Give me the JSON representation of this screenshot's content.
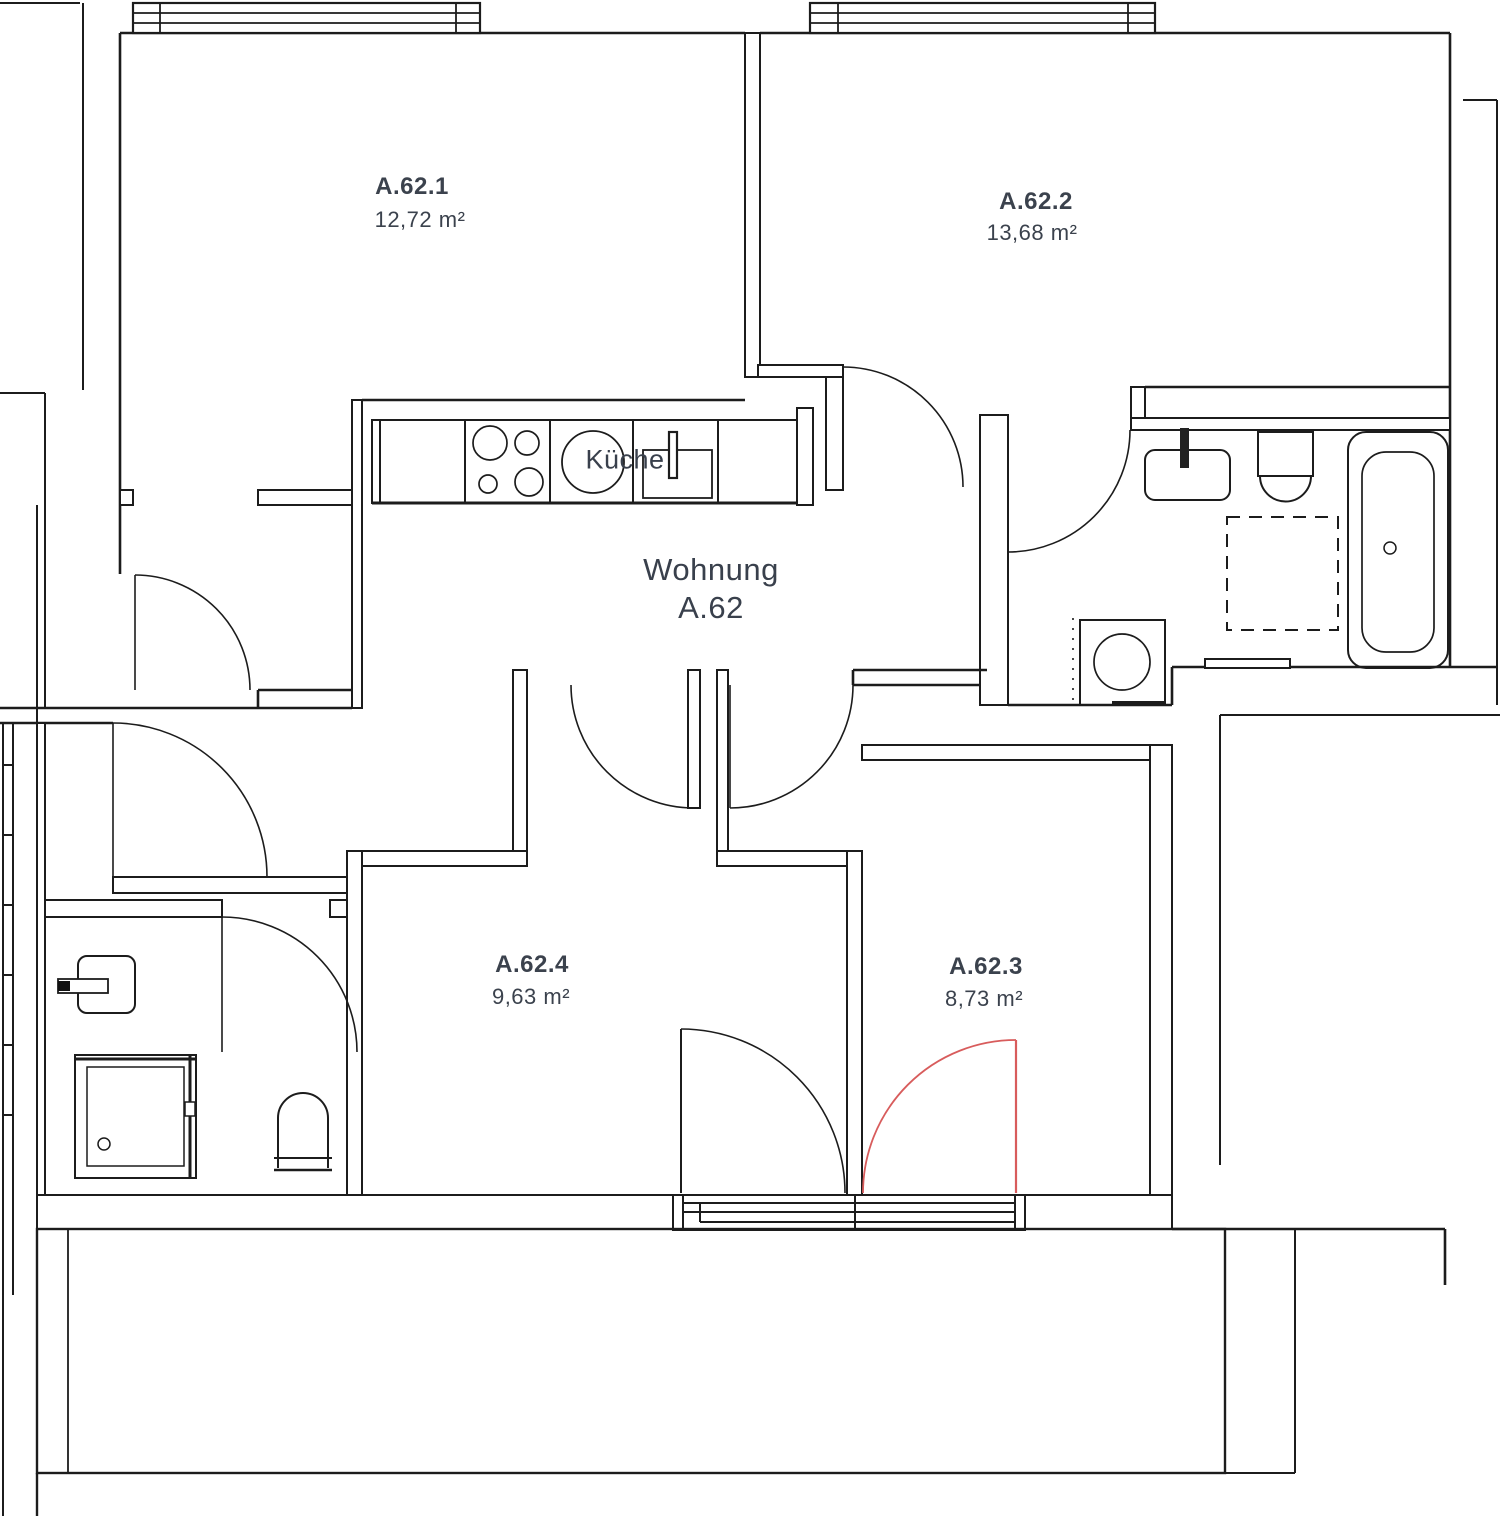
{
  "title": {
    "line1": "Wohnung",
    "line2": "A.62"
  },
  "kitchen": {
    "label": "Küche"
  },
  "rooms": [
    {
      "name": "A.62.1",
      "area": "12,72 m²"
    },
    {
      "name": "A.62.2",
      "area": "13,68 m²"
    },
    {
      "name": "A.62.3",
      "area": "8,73 m²"
    },
    {
      "name": "A.62.4",
      "area": "9,63 m²"
    }
  ],
  "colors": {
    "wall": "#1c1c1c",
    "text": "#3b424d",
    "accent_door": "#d85c5c",
    "background": "#ffffff"
  },
  "fixtures": [
    "stove-icon",
    "kitchen-sink-icon",
    "wash-basin-icon",
    "toilet-icon",
    "bathtub-icon",
    "shower-icon",
    "washing-machine-icon",
    "door-swing-icon",
    "window-icon",
    "balcony"
  ]
}
